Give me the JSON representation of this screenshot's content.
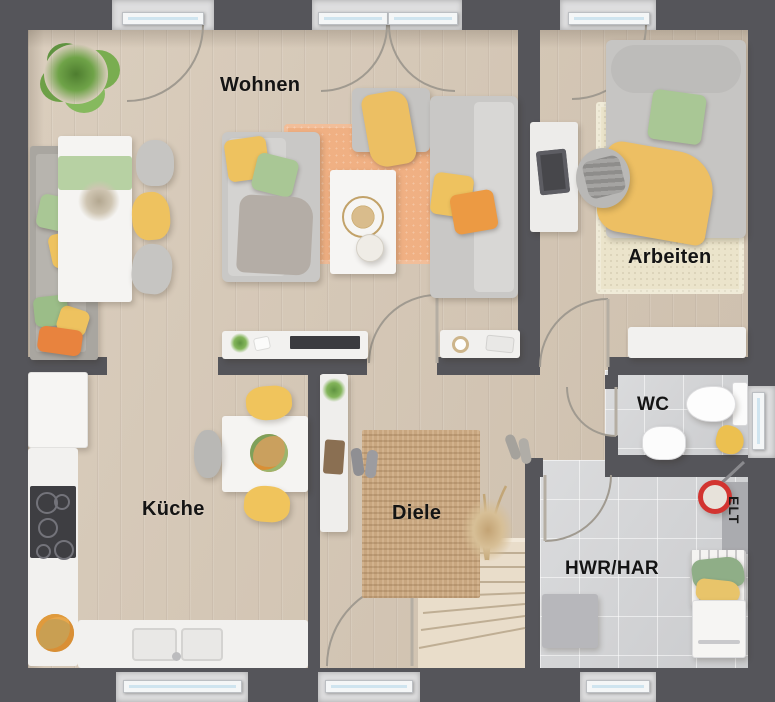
{
  "floorplan": {
    "rooms": [
      {
        "id": "wohnen",
        "label": "Wohnen",
        "floor": "wood"
      },
      {
        "id": "arbeiten",
        "label": "Arbeiten",
        "floor": "wood"
      },
      {
        "id": "kueche",
        "label": "Küche",
        "floor": "wood"
      },
      {
        "id": "diele",
        "label": "Diele",
        "floor": "wood"
      },
      {
        "id": "wc",
        "label": "WC",
        "floor": "tile"
      },
      {
        "id": "hwr_har",
        "label": "HWR/HAR",
        "floor": "tile"
      },
      {
        "id": "elt",
        "label": "ELT",
        "floor": "tile"
      }
    ],
    "colors": {
      "wall": "#55555a",
      "exterior": "#67676b",
      "wood_floor": "#d6c8b6",
      "tile_floor": "#d3d4d6",
      "window_glass": "#cfe4ef",
      "window_frame": "#f4f6f7",
      "door_arc": "#a09a90",
      "door_leaf": "#b5aea3",
      "rug_peach": "#f0b083",
      "rug_cream": "#ebe4cb",
      "rug_jute": "#c8a67f",
      "sofa_gray": "#c9c8c6",
      "accent_yellow": "#eec25f",
      "accent_green": "#a9c795",
      "accent_orange": "#ec9a43",
      "bucket_red": "#d23430",
      "stairs_wood": "#e9ddca"
    },
    "furniture": [
      "corner-plant",
      "dining-bench",
      "dining-table",
      "dining-chairs",
      "sofa",
      "chaise",
      "coffee-table",
      "living-rug",
      "tv-sideboard",
      "wall-shelf",
      "desk",
      "laptop",
      "office-chair",
      "daybed",
      "work-rug",
      "work-sideboard",
      "kitchen-tall-cabinet",
      "kitchen-counter",
      "cooktop",
      "kitchen-sink",
      "kitchen-table",
      "kitchen-chairs",
      "fruit-bowl",
      "shoe-cabinet",
      "jute-rug",
      "dried-plant",
      "shoes",
      "staircase",
      "toilet",
      "wc-sink",
      "towel",
      "elt-panel",
      "mop-bucket",
      "drying-rack",
      "washing-machine",
      "storage-box"
    ],
    "openings": {
      "windows": 7,
      "doors": 8
    }
  }
}
